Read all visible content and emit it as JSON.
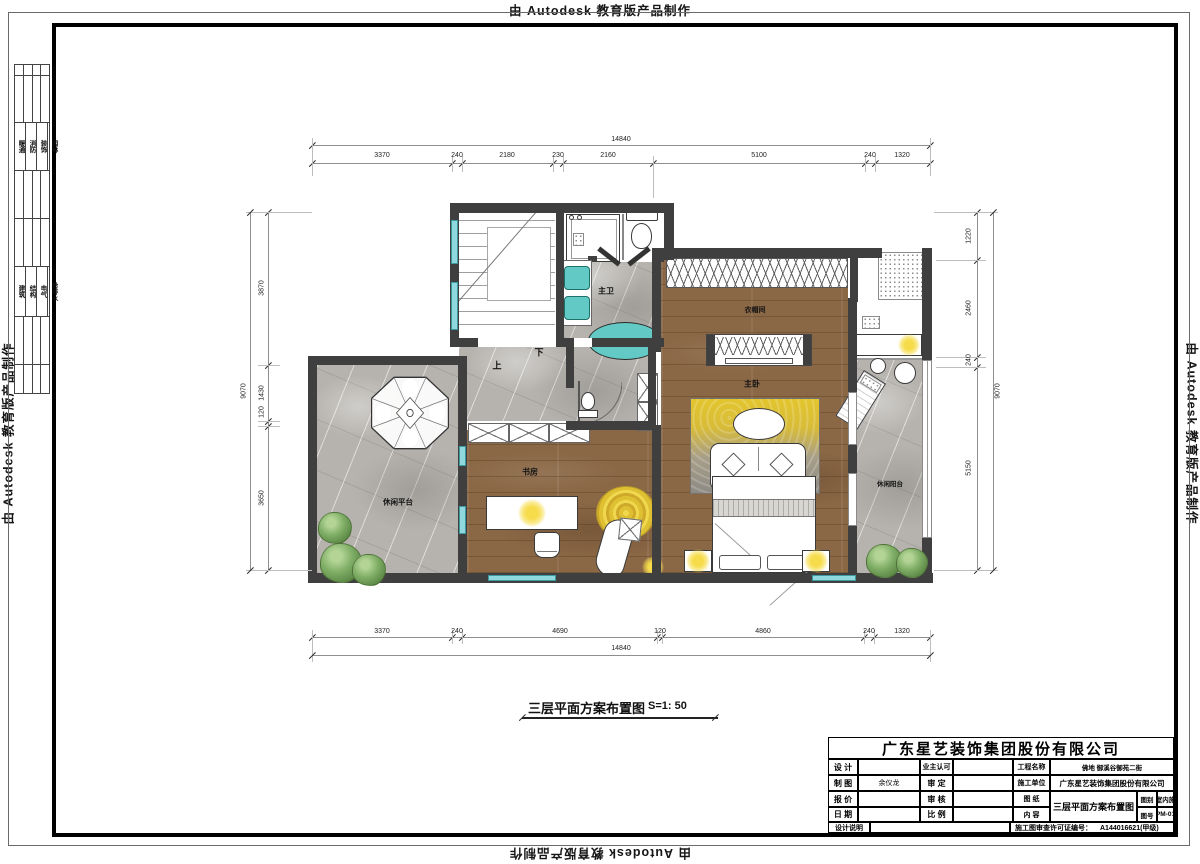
{
  "stamp": {
    "text": "由 Autodesk 教育版产品制作"
  },
  "sidebar": {
    "disciplines_top": [
      "暖通",
      "消防",
      "装饰",
      "园林"
    ],
    "disciplines_bottom": [
      "建筑",
      "结构",
      "电气",
      "给排水"
    ]
  },
  "plan": {
    "title": "三层平面方案布置图",
    "scale": "S=1: 50",
    "rooms": {
      "master_bath": "主卫",
      "cloakroom": "衣帽间",
      "master_bedroom": "主卧",
      "leisure_balcony": "休闲阳台",
      "leisure_terrace": "休闲平台",
      "study": "书房",
      "stair_up": "上",
      "stair_down": "下"
    },
    "dims": {
      "top_total": "14840",
      "top": [
        "3370",
        "240",
        "2180",
        "230",
        "2160",
        "5100",
        "240",
        "1320"
      ],
      "bottom": [
        "3370",
        "240",
        "4690",
        "120",
        "4860",
        "240",
        "1320"
      ],
      "bottom_total": "14840",
      "left_total": "9070",
      "left": [
        "3870",
        "1430",
        "120",
        "3650"
      ],
      "right": [
        "1220",
        "2460",
        "240",
        "5150"
      ],
      "right_total": "9070"
    }
  },
  "titleblock": {
    "company": "广东星艺装饰集团股份有限公司",
    "design_label": "设 计",
    "owner_label": "业主认可",
    "project_label": "工程名称",
    "project_value": "佛地 御溪谷御苑二街",
    "draft_label": "制 图",
    "draft_value": "余仪龙",
    "approve_label": "审 定",
    "contractor_label": "施工单位",
    "contractor_value": "广东星艺装饰集团股份有限公司",
    "quote_label": "报 价",
    "check_label": "审 核",
    "sheet_label": "图 纸",
    "content_label": "内 容",
    "sheet_value": "三层平面方案布置图",
    "category_label": "图别",
    "category_value": "室内施",
    "number_label": "图号",
    "number_value": "PM-01",
    "date_label": "日 期",
    "ratio_label": "比 例",
    "note_label": "设计说明",
    "license_label": "施工图审查许可证编号：",
    "license_value": "A144016621(甲级)"
  },
  "colors": {
    "wall": "#3f3f3f",
    "wood": "#8a6745",
    "stone": "#b6b3ae",
    "fixture_teal": "#63c9c4",
    "window_glass": "#8fd8de",
    "accent_yellow": "#eecf3a",
    "plant_green": "#7fae66"
  }
}
